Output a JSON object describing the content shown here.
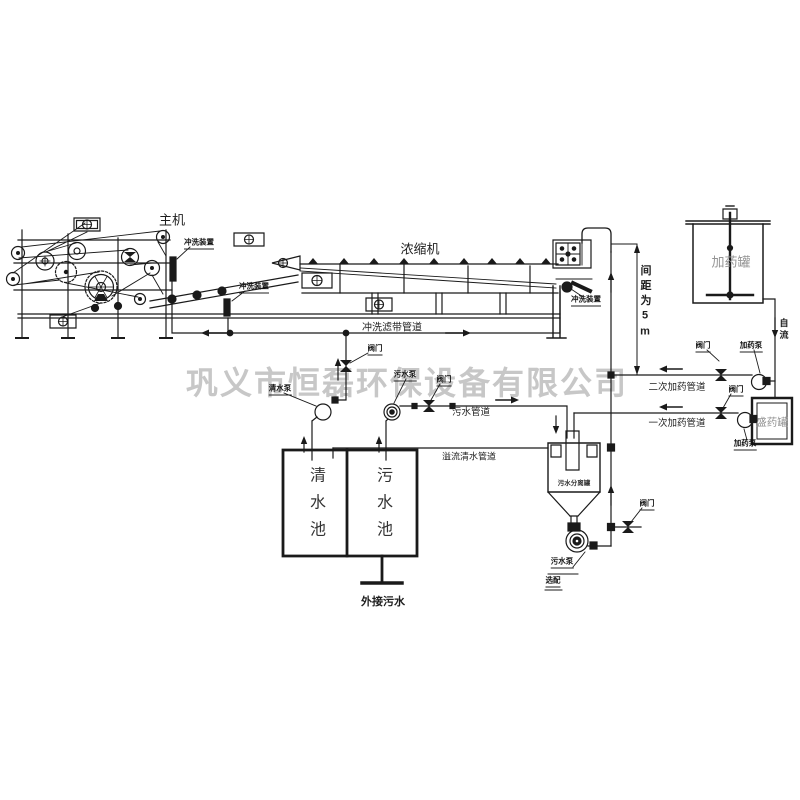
{
  "watermark": "巩义市恒磊环保设备有限公司",
  "colors": {
    "line": "#1a1a1a",
    "watermark": "#c7c7c7",
    "faint_label": "#949494"
  },
  "machines": {
    "main_press": "主机",
    "thickener": "浓缩机"
  },
  "devices": {
    "wash_device": "冲洗装置",
    "valve": "阀门",
    "clean_water_pump": "清水泵",
    "sewage_pump": "污水泵",
    "dosing_pump": "加药泵",
    "separator_pump": "污水泵",
    "optional": "选配"
  },
  "pipes": {
    "belt_wash_pipe": "冲洗滤带管道",
    "sewage_pipe": "污水管道",
    "overflow_clean_pipe": "溢流清水管道",
    "secondary_dosing_pipe": "二次加药管道",
    "primary_dosing_pipe": "一次加药管道"
  },
  "tanks": {
    "clean_water_tank": "清水池",
    "sewage_tank": "污水池",
    "dosing_tank": "加药罐",
    "holding_tank": "盛药罐",
    "separator": "污水分离罐"
  },
  "annotations": {
    "spacing_note": "间距为5m",
    "gravity_flow": "自流",
    "external_sewage": "外接污水"
  }
}
